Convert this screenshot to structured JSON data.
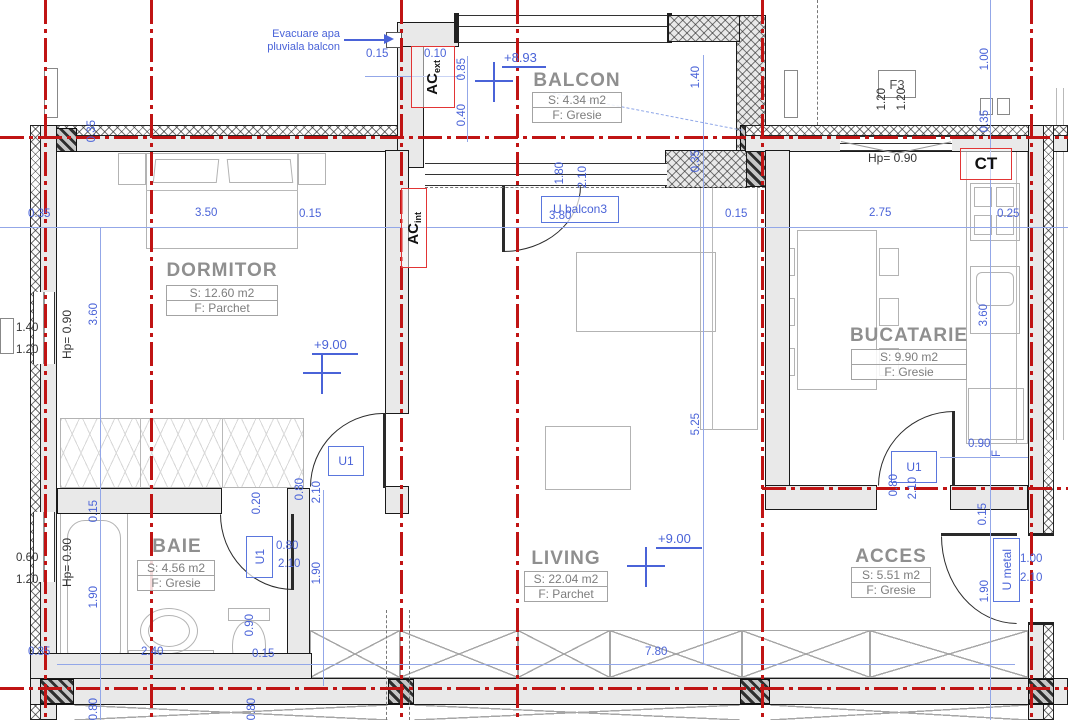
{
  "note": {
    "line1": "Evacuare apa",
    "line2": "pluviala balcon"
  },
  "rooms": {
    "balcon": {
      "name": "BALCON",
      "area": "S: 4.34 m2",
      "floor": "F: Gresie"
    },
    "dormitor": {
      "name": "DORMITOR",
      "area": "S: 12.60 m2",
      "floor": "F: Parchet"
    },
    "bucatarie": {
      "name": "BUCATARIE",
      "area": "S: 9.90 m2",
      "floor": "F: Gresie"
    },
    "baie": {
      "name": "BAIE",
      "area": "S: 4.56 m2",
      "floor": "F: Gresie"
    },
    "living": {
      "name": "LIVING",
      "area": "S: 22.04 m2",
      "floor": "F: Parchet"
    },
    "acces": {
      "name": "ACCES",
      "area": "S: 5.51 m2",
      "floor": "F: Gresie"
    }
  },
  "levels": {
    "balcon": "+8.93",
    "dormitor": "+9.00",
    "living": "+9.00"
  },
  "tags": {
    "ac_ext": {
      "main": "AC",
      "sub": "ext"
    },
    "ac_int": {
      "main": "AC",
      "sub": "int"
    },
    "f3": "F3",
    "ct": "CT",
    "u_balcon3": "U balcon3",
    "u1": "U1",
    "u_metal": "U metal",
    "f_counter": "F"
  },
  "hp_label": "Hp= 0.90",
  "dims": {
    "balcony_top": {
      "d1": "0.15",
      "d2": "0.10",
      "d3": "0.85",
      "d4": "0.40",
      "d5": "1.40",
      "d6": "0.35"
    },
    "main_row": {
      "d1": "0.35",
      "d2": "3.50",
      "d3": "0.15",
      "d4": "3.80",
      "d5": "0.15",
      "d6": "2.75",
      "d7": "0.25"
    },
    "right_top": {
      "d1": "1.00",
      "d2": "0.35",
      "d3": "1.20",
      "d4": "1.20"
    },
    "left_window_up": {
      "d1": "1.40",
      "d2": "1.20"
    },
    "left_window_low": {
      "d1": "0.60",
      "d2": "1.20"
    },
    "left_col": {
      "d0": "0.35",
      "d1": "3.60",
      "d2": "0.15",
      "d3": "1.90",
      "d4": "0.80"
    },
    "balcony_door": {
      "d1": "1.80",
      "d2": "2.10"
    },
    "dormitor_door": {
      "d1": "0.80",
      "d2": "2.10"
    },
    "baie_door": {
      "d1": "0.20",
      "d2": "0.80",
      "d3": "2.10",
      "d4": "1.90"
    },
    "kitchen": {
      "d1": "3.60",
      "d2": "0.90"
    },
    "kitchen_door": {
      "d1": "0.80",
      "d2": "2.10"
    },
    "living": {
      "d1": "5.25"
    },
    "entry": {
      "d1": "0.15",
      "d2": "1.90",
      "d3": "1.00",
      "d4": "2.10"
    },
    "bottom": {
      "d1": "0.35",
      "d2": "2.40",
      "d3": "0.90",
      "d4": "0.15",
      "d5": "7.80",
      "d6": "0.80"
    }
  },
  "colors": {
    "axis_red": "#c01414",
    "dim_blue": "#4a63d8",
    "wall_fill": "#e9e9e9",
    "label_gray": "#8f8f8f",
    "tag_red": "#e23535"
  }
}
